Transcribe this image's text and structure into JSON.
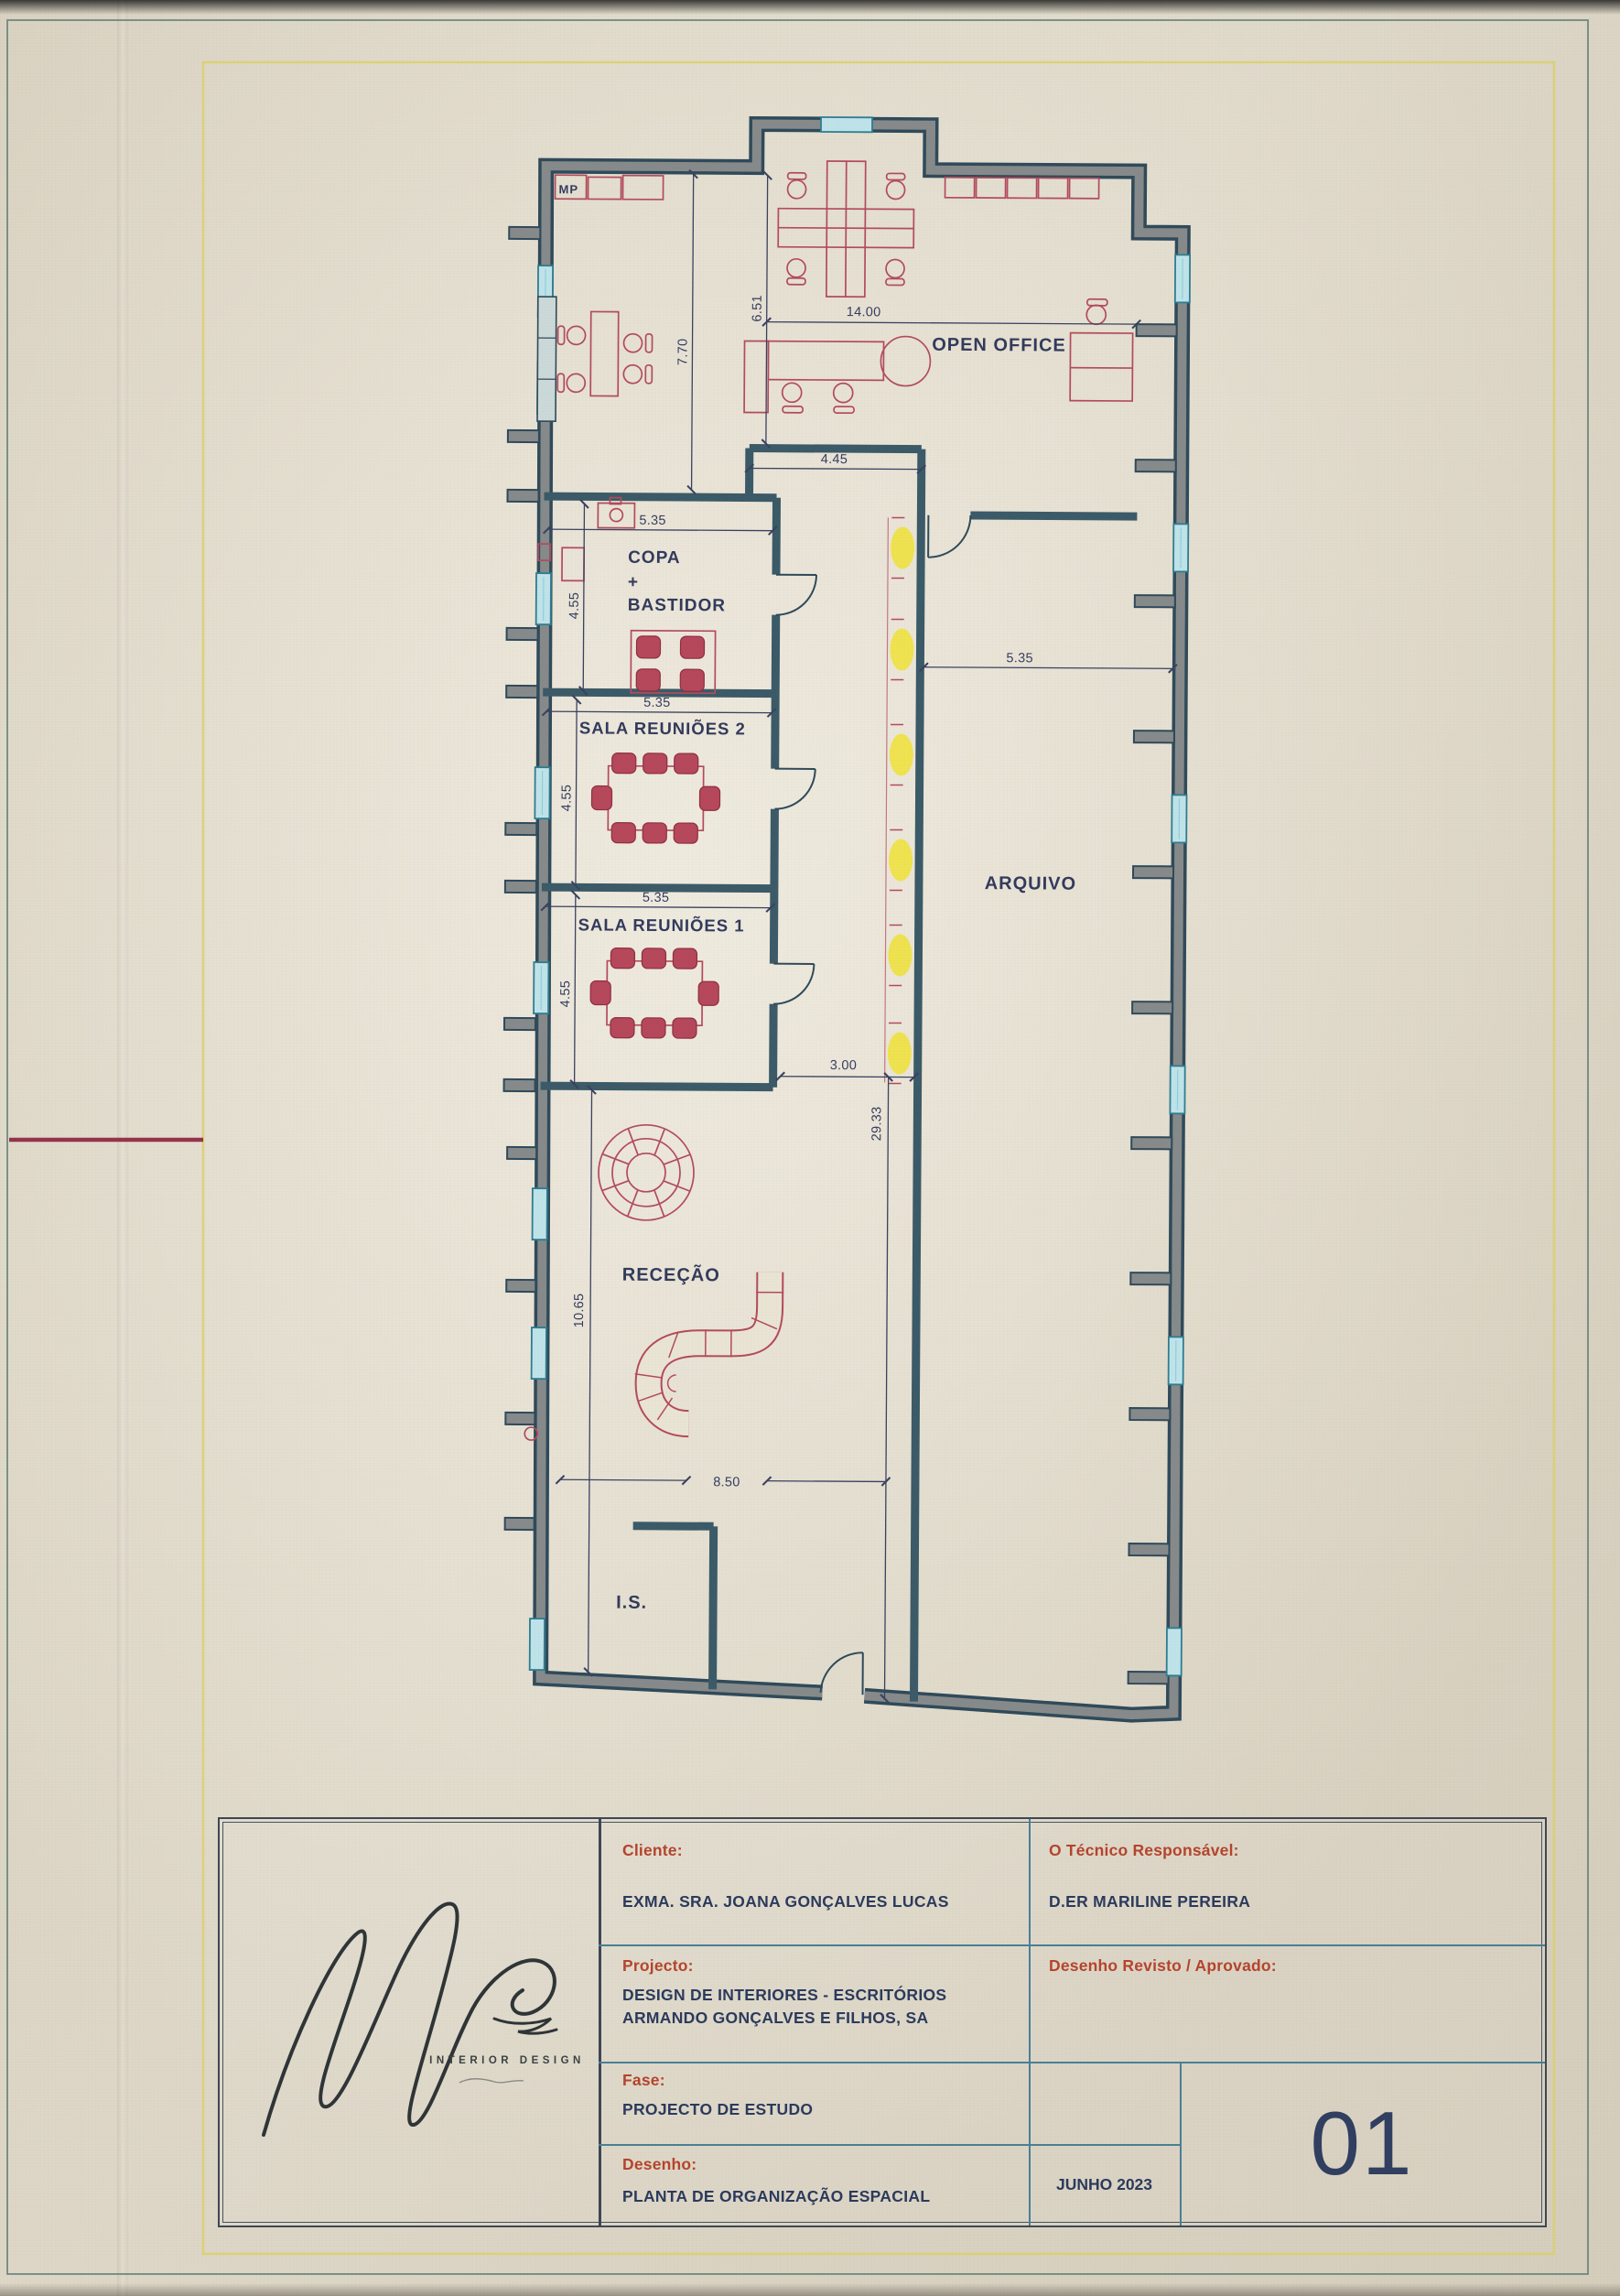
{
  "document": {
    "type": "architectural-floor-plan",
    "sheet_number": "01",
    "date": "JUNHO 2023"
  },
  "plan": {
    "labels": {
      "open_office": "OPEN OFFICE",
      "copa_line1": "COPA",
      "copa_line2": "+",
      "copa_line3": "BASTIDOR",
      "sala_reunioes_2": "SALA REUNIÕES 2",
      "sala_reunioes_1": "SALA REUNIÕES 1",
      "arquivo": "ARQUIVO",
      "rececao": "RECEÇÃO",
      "is": "I.S.",
      "mp": "MP"
    },
    "dims": {
      "open_office_width": "14.00",
      "open_office_height_right": "6.51",
      "open_office_height_left": "7.70",
      "open_office_balcony": "4.45",
      "copa_width": "5.35",
      "copa_height": "4.55",
      "sala2_width": "5.35",
      "sala2_height": "4.55",
      "sala1_width": "5.35",
      "sala1_height": "4.55",
      "arquivo_width": "5.35",
      "corridor_width": "3.00",
      "total_height": "29.33",
      "rececao_height": "10.65",
      "rececao_width": "8.50"
    }
  },
  "title_block": {
    "cliente_label": "Cliente:",
    "cliente_value": "EXMA. SRA. JOANA GONÇALVES LUCAS",
    "projecto_label": "Projecto:",
    "projecto_value": "DESIGN DE INTERIORES - ESCRITÓRIOS ARMANDO GONÇALVES E FILHOS, SA",
    "fase_label": "Fase:",
    "fase_value": "PROJECTO DE ESTUDO",
    "desenho_label": "Desenho:",
    "desenho_value": "PLANTA DE ORGANIZAÇÃO ESPACIAL",
    "tecnico_label": "O Técnico Responsável:",
    "tecnico_value": "D.ER MARILINE PEREIRA",
    "revisto_label": "Desenho Revisto / Aprovado:",
    "date": "JUNHO 2023",
    "sheet_number": "01",
    "logo_text": "INTERIOR DESIGN"
  },
  "colors": {
    "paper": "#eae4d5",
    "wall_core": "#868a8a",
    "wall_edge": "#2f4a5a",
    "window": "#bfe3ea",
    "window_frame": "#2e7d91",
    "furniture_red": "#b34b5c",
    "dimension_navy": "#353c5e",
    "highlighter_yellow": "#f0e232",
    "frame_yellow": "#ddd06a",
    "edge_red_mark": "#93334a",
    "title_label_red": "#b5442c",
    "title_value_navy": "#2b3a5c",
    "grid_blue": "#4a7f96"
  }
}
